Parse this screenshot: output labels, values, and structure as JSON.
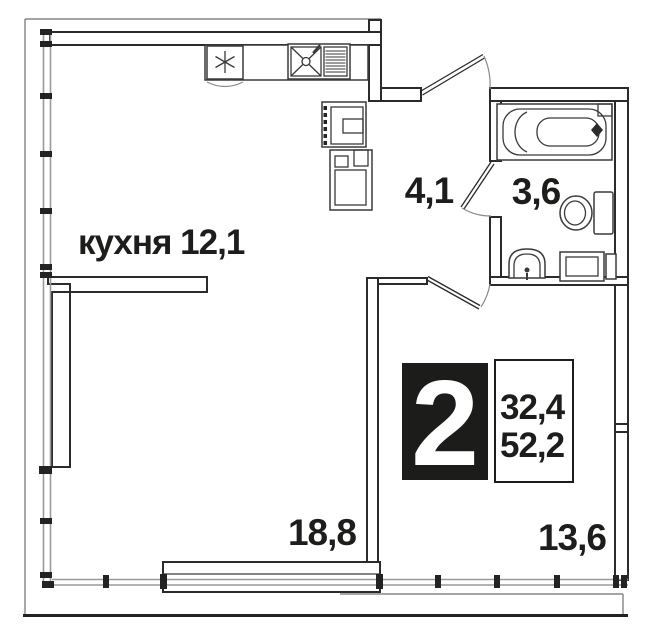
{
  "rooms": [
    {
      "id": "kitchen",
      "label": "кухня 12,1"
    },
    {
      "id": "hallway",
      "label": "4,1"
    },
    {
      "id": "bathroom",
      "label": "3,6"
    },
    {
      "id": "living-room",
      "label": "18,8"
    },
    {
      "id": "bedroom",
      "label": "13,6"
    }
  ],
  "badge": {
    "room_count": "2",
    "upper_value": "32,4",
    "lower_value": "52,2"
  },
  "icons": {
    "fridge": "snowflake-asterisk",
    "kitchen_sink": "sink-with-drainer",
    "stove": "oven",
    "bathtub": "bathtub",
    "toilet": "toilet",
    "bathroom_sink": "washbasin",
    "washing_machine": "washing-machine"
  },
  "colors": {
    "wall": "#2b2b2b",
    "glazing": "#9a9a9a",
    "badge_bg": "#1c1c1a",
    "badge_text": "#ffffff",
    "background": "#ffffff",
    "text": "#1d1d1b"
  }
}
